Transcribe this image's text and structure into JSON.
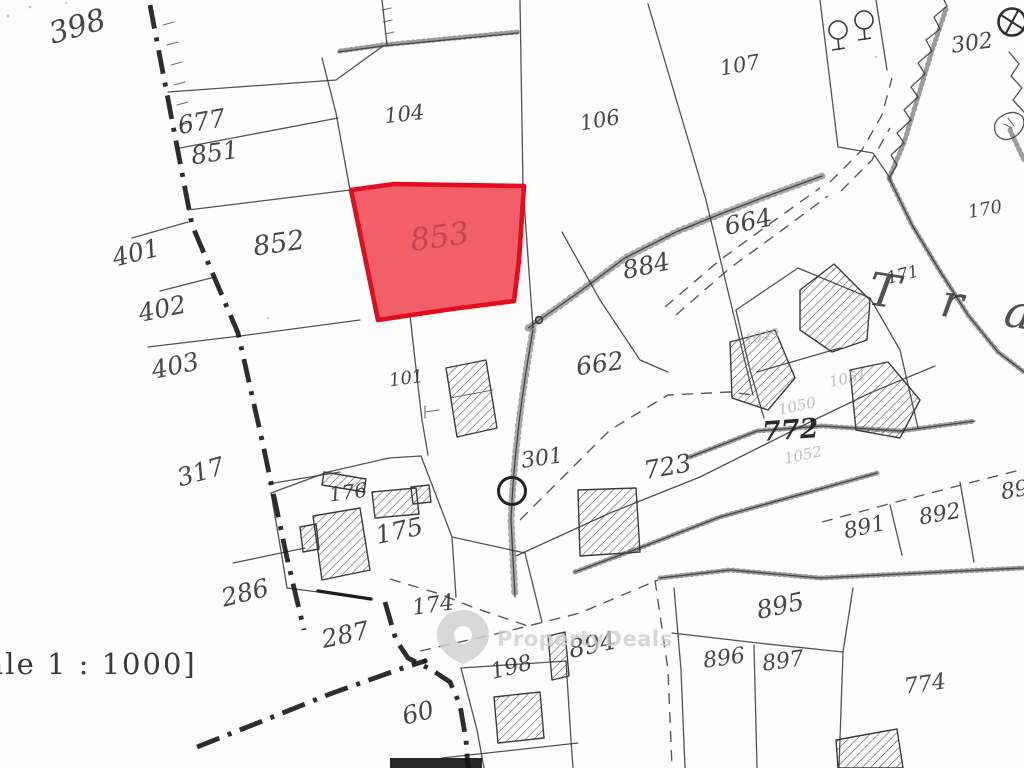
{
  "page": {
    "title": "Cadastral plan extract",
    "scale_label": "ale 1 : 1000]"
  },
  "watermark": {
    "brand": "PropertyDeals",
    "icon": "map-pin-icon"
  },
  "highlight": {
    "parcel_id": "853",
    "fill": "#ef4e59",
    "stroke": "#e20d1f",
    "fill_opacity": "0.9",
    "label_color": "#c34452"
  },
  "place_name": {
    "text": "T r a"
  },
  "symbols": [
    {
      "name": "survey-circle-icon",
      "label": "302"
    },
    {
      "name": "junction-circle-icon",
      "label": "301"
    },
    {
      "name": "tree-icon",
      "count": 2
    }
  ],
  "parcel_labels": [
    {
      "text": "398",
      "x": 80,
      "y": 36,
      "rot": -16,
      "size": 30,
      "style": "h"
    },
    {
      "text": "677",
      "x": 203,
      "y": 130,
      "rot": -10,
      "size": 25,
      "style": "h"
    },
    {
      "text": "851",
      "x": 216,
      "y": 161,
      "rot": -8,
      "size": 25,
      "style": "h"
    },
    {
      "text": "104",
      "x": 405,
      "y": 121,
      "rot": -6,
      "size": 21,
      "style": "h"
    },
    {
      "text": "106",
      "x": 601,
      "y": 127,
      "rot": -10,
      "size": 21,
      "style": "h"
    },
    {
      "text": "107",
      "x": 741,
      "y": 72,
      "rot": -10,
      "size": 21,
      "style": "h"
    },
    {
      "text": "302",
      "x": 973,
      "y": 50,
      "rot": -8,
      "size": 22,
      "style": "h"
    },
    {
      "text": "401",
      "x": 138,
      "y": 261,
      "rot": -14,
      "size": 25,
      "style": "h"
    },
    {
      "text": "852",
      "x": 280,
      "y": 252,
      "rot": -8,
      "size": 27,
      "style": "h"
    },
    {
      "text": "853",
      "x": 441,
      "y": 247,
      "rot": -8,
      "size": 31,
      "style": "red"
    },
    {
      "text": "402",
      "x": 164,
      "y": 317,
      "rot": -12,
      "size": 25,
      "style": "h"
    },
    {
      "text": "403",
      "x": 177,
      "y": 374,
      "rot": -12,
      "size": 25,
      "style": "h"
    },
    {
      "text": "664",
      "x": 750,
      "y": 230,
      "rot": -12,
      "size": 25,
      "style": "h"
    },
    {
      "text": "884",
      "x": 648,
      "y": 274,
      "rot": -12,
      "size": 25,
      "style": "h"
    },
    {
      "text": "170",
      "x": 986,
      "y": 215,
      "rot": -10,
      "size": 18,
      "style": "h"
    },
    {
      "text": "171",
      "x": 904,
      "y": 280,
      "rot": -14,
      "size": 17,
      "style": "h"
    },
    {
      "text": "T r a",
      "x": 955,
      "y": 318,
      "rot": 9,
      "size": 46,
      "style": "place"
    },
    {
      "text": "662",
      "x": 601,
      "y": 372,
      "rot": -8,
      "size": 25,
      "style": "h"
    },
    {
      "text": "101",
      "x": 407,
      "y": 384,
      "rot": -8,
      "size": 18,
      "style": "h"
    },
    {
      "text": "1049",
      "x": 763,
      "y": 341,
      "rot": -12,
      "size": 14,
      "style": "f"
    },
    {
      "text": "1051",
      "x": 849,
      "y": 383,
      "rot": -12,
      "size": 15,
      "style": "f"
    },
    {
      "text": "1050",
      "x": 798,
      "y": 411,
      "rot": -12,
      "size": 15,
      "style": "f"
    },
    {
      "text": "772",
      "x": 791,
      "y": 439,
      "rot": -4,
      "size": 27,
      "style": "b"
    },
    {
      "text": "1052",
      "x": 804,
      "y": 460,
      "rot": -12,
      "size": 15,
      "style": "f"
    },
    {
      "text": "301",
      "x": 543,
      "y": 465,
      "rot": -8,
      "size": 22,
      "style": "h"
    },
    {
      "text": "317",
      "x": 203,
      "y": 480,
      "rot": -16,
      "size": 25,
      "style": "h"
    },
    {
      "text": "176",
      "x": 349,
      "y": 499,
      "rot": -8,
      "size": 20,
      "style": "h"
    },
    {
      "text": "723",
      "x": 669,
      "y": 475,
      "rot": -10,
      "size": 25,
      "style": "h"
    },
    {
      "text": "175",
      "x": 401,
      "y": 539,
      "rot": -12,
      "size": 25,
      "style": "h"
    },
    {
      "text": "891",
      "x": 866,
      "y": 534,
      "rot": -12,
      "size": 22,
      "style": "h"
    },
    {
      "text": "892",
      "x": 941,
      "y": 521,
      "rot": -10,
      "size": 22,
      "style": "h"
    },
    {
      "text": "89",
      "x": 1016,
      "y": 497,
      "rot": -10,
      "size": 22,
      "style": "h"
    },
    {
      "text": "286",
      "x": 247,
      "y": 601,
      "rot": -14,
      "size": 25,
      "style": "h"
    },
    {
      "text": "895",
      "x": 782,
      "y": 614,
      "rot": -12,
      "size": 25,
      "style": "h"
    },
    {
      "text": "287",
      "x": 347,
      "y": 643,
      "rot": -12,
      "size": 25,
      "style": "h"
    },
    {
      "text": "174",
      "x": 434,
      "y": 612,
      "rot": -8,
      "size": 22,
      "style": "h"
    },
    {
      "text": "894",
      "x": 594,
      "y": 653,
      "rot": -12,
      "size": 25,
      "style": "h"
    },
    {
      "text": "198",
      "x": 513,
      "y": 674,
      "rot": -14,
      "size": 22,
      "style": "h"
    },
    {
      "text": "896",
      "x": 725,
      "y": 665,
      "rot": -8,
      "size": 22,
      "style": "h"
    },
    {
      "text": "897",
      "x": 784,
      "y": 668,
      "rot": -8,
      "size": 22,
      "style": "h"
    },
    {
      "text": "60",
      "x": 420,
      "y": 721,
      "rot": -14,
      "size": 25,
      "style": "h"
    },
    {
      "text": "774",
      "x": 926,
      "y": 691,
      "rot": -8,
      "size": 22,
      "style": "h"
    }
  ]
}
